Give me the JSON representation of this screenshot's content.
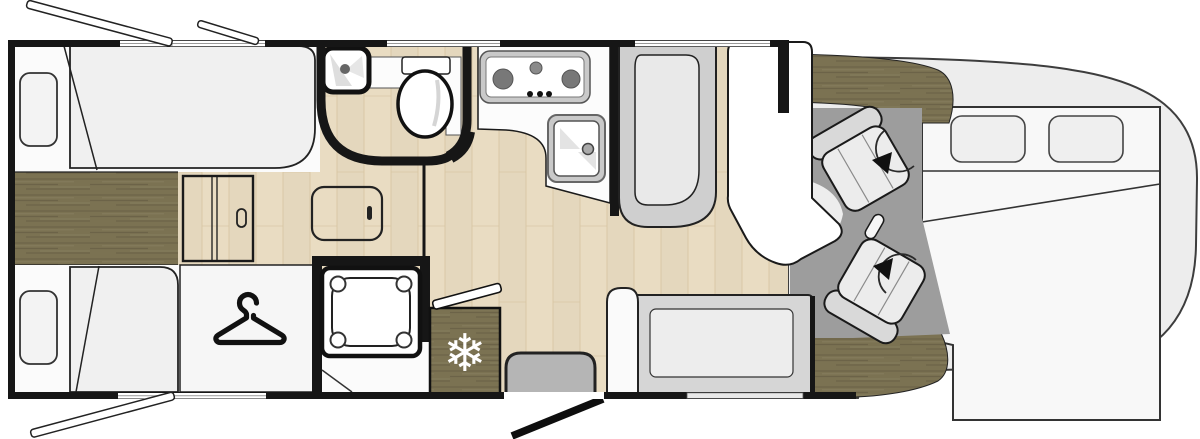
{
  "meta": {
    "description": "Motorhome floor plan, top-down diagram, no visible text labels",
    "view": "plan"
  },
  "colors": {
    "wall": "#161616",
    "body": "#ededed",
    "outline": "#3d3d3d",
    "floor_light": "#e9dcc2",
    "floor_light_grain": "#d6c3a0",
    "wood_dark": "#7b7252",
    "wood_dark_grain": "#665d44",
    "cab_floor": "#9d9d9d",
    "furniture_white": "#fbfbfb",
    "fabric_light": "#efefef",
    "seat_gray": "#d9d9d9",
    "bench_gray": "#cfcfcf",
    "step_gray": "#b5b5b5",
    "appliance_gray": "#c9c9c9",
    "burner_gray": "#787878",
    "snowflake_white": "#ffffff"
  },
  "icons": {
    "snowflake": {
      "name": "snowflake-icon",
      "glyph": "❄",
      "meaning": "fridge"
    },
    "hanger": {
      "name": "hanger-icon",
      "meaning": "wardrobe"
    },
    "swivel_arrow": {
      "name": "rotate-arrow-icon",
      "meaning": "swivel seat",
      "count": 2
    }
  },
  "elements": {
    "rooms": [
      "rear-twin-beds",
      "center-walkway",
      "wardrobe",
      "bathroom",
      "shower",
      "kitchen",
      "fridge",
      "entry-step",
      "dinette",
      "cab-swivel-seats",
      "drop-down-bed"
    ],
    "windows_open_flaps": {
      "top": 2,
      "bottom": 1
    },
    "burners_on_stove": 3,
    "pillows_front_bed": 2
  }
}
